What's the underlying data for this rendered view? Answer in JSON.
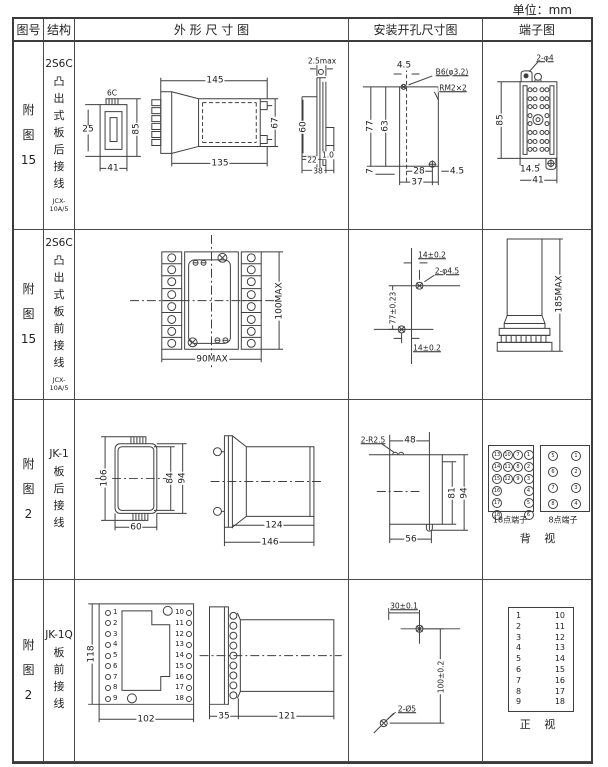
{
  "unit_label": "单位：mm",
  "header": {
    "figure": "图号",
    "structure": "结构",
    "outline": "外 形 尺 寸 图",
    "mounting": "安装开孔尺寸图",
    "terminal": "端子图"
  },
  "rows": [
    {
      "figure": "附\n图\n15",
      "structure_title": "2S6C",
      "structure_body": "凸\n出\n式\n板\n后\n接\n线",
      "model": "JCX-10A/5",
      "outline": {
        "tab": "6C",
        "depth": "25",
        "height": "85",
        "width": "41",
        "length_total": "145",
        "length_body": "135",
        "body_height": "67",
        "panel_max": "2.5max",
        "cutout_h": "60",
        "d22": "22",
        "d10": "1.0",
        "d38": "38"
      },
      "mounting": {
        "offset_top": "4.5",
        "hole_spec": "B6(φ3.2)",
        "thread_spec": "RM2×2",
        "h_outer": "77",
        "h_inner": "63",
        "bottom_gap": "7",
        "w_inner": "28",
        "w_outer": "37",
        "offset_right": "4.5"
      },
      "terminal": {
        "holes": "2-φ4",
        "height": "85",
        "w_inner": "14.5",
        "w_outer": "41"
      }
    },
    {
      "figure": "附\n图\n15",
      "structure_title": "2S6C",
      "structure_body": "凸\n出\n式\n板\n前\n接\n线",
      "model": "JCX-10A/5",
      "outline": {
        "height": "100MAX",
        "width": "90MAX"
      },
      "mounting": {
        "top": "14±0.2",
        "holes": "2-φ4.5",
        "height": "77±0.23",
        "bottom": "14±0.2"
      },
      "terminal": {
        "height": "185MAX"
      }
    },
    {
      "figure": "附\n图\n2",
      "structure_title": "JK-1",
      "structure_body": "板\n后\n接\n线",
      "model": "",
      "outline": {
        "front_h": "106",
        "inner_h": "84",
        "outer_h": "94",
        "front_w": "60",
        "body_len": "124",
        "total_len": "146"
      },
      "mounting": {
        "corner": "2-R2.5",
        "top_w": "48",
        "inner_h": "81",
        "outer_h": "94",
        "bottom_w": "56"
      },
      "terminal": {
        "grid18": [
          "13",
          "10",
          "7",
          "1",
          "14",
          "11",
          "8",
          "2",
          "15",
          "12",
          "9",
          "3",
          "16",
          "",
          "",
          "4",
          "17",
          "",
          "",
          "5",
          "18",
          "",
          "",
          "6"
        ],
        "grid8": [
          "5",
          "1",
          "6",
          "2",
          "7",
          "3",
          "8",
          "4"
        ],
        "label18": "18点端子",
        "label8": "8点端子",
        "view": "背 视"
      }
    },
    {
      "figure": "附\n图\n2",
      "structure_title": "JK-1Q",
      "structure_body": "板\n前\n接\n线",
      "model": "",
      "outline": {
        "front_h": "118",
        "front_w": "102",
        "pins_left": [
          "1",
          "2",
          "3",
          "4",
          "5",
          "6",
          "7",
          "8",
          "9"
        ],
        "pins_right": [
          "10",
          "11",
          "12",
          "13",
          "14",
          "15",
          "16",
          "17",
          "18"
        ],
        "flange_w": "35",
        "body_len": "121"
      },
      "mounting": {
        "top_w": "30±0.1",
        "height": "100±0.2",
        "holes": "2-Ø5"
      },
      "terminal": {
        "left_col": [
          "1",
          "2",
          "3",
          "4",
          "5",
          "6",
          "7",
          "8",
          "9"
        ],
        "right_col": [
          "10",
          "11",
          "12",
          "13",
          "14",
          "15",
          "16",
          "17",
          "18"
        ],
        "view": "正 视"
      }
    }
  ]
}
